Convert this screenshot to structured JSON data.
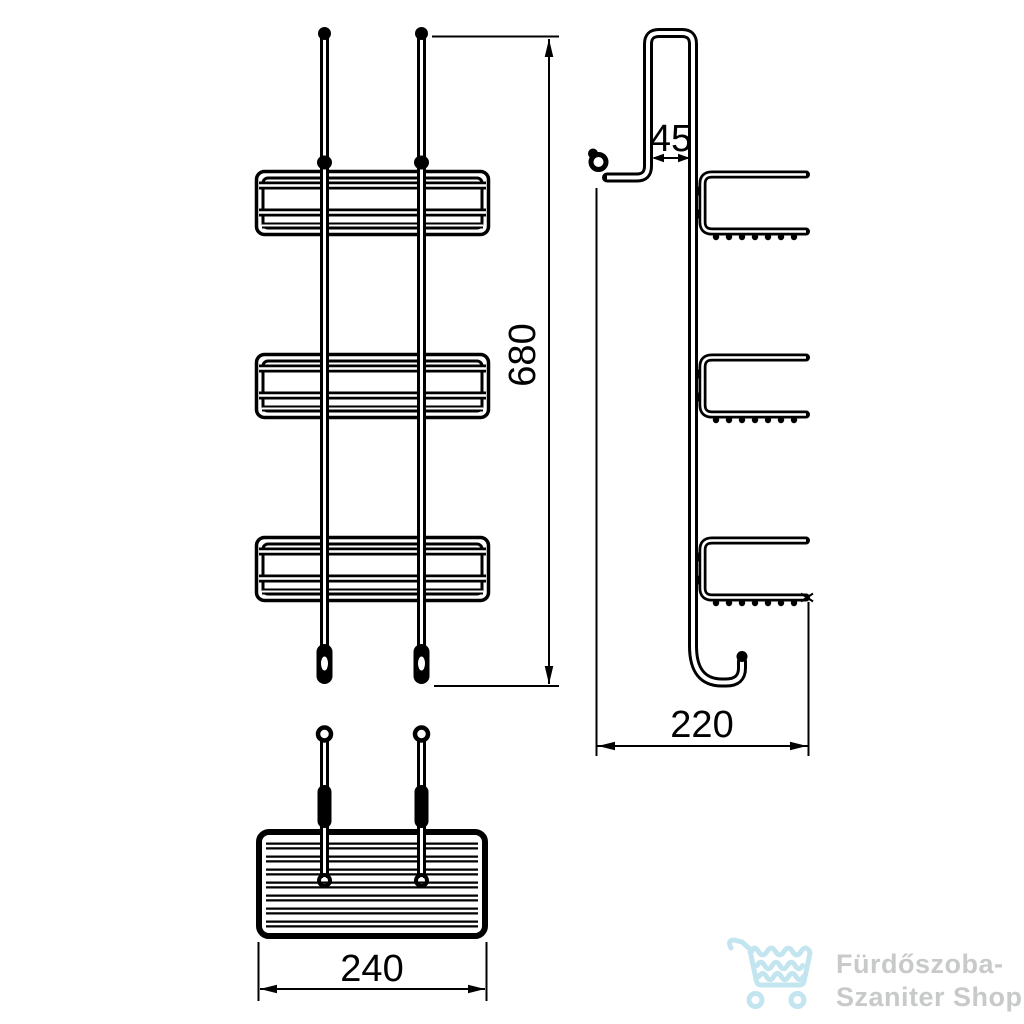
{
  "dimensions": {
    "front_height": "680",
    "hook_gap": "45",
    "side_depth": "220",
    "basket_width": "240"
  },
  "logo": {
    "line1": "Fürdőszoba-",
    "line2": "Szaniter Shop",
    "cart_color": "#c3e5ef",
    "text_color": "#c7cac9"
  },
  "colors": {
    "background": "#ffffff",
    "line": "#000000"
  }
}
